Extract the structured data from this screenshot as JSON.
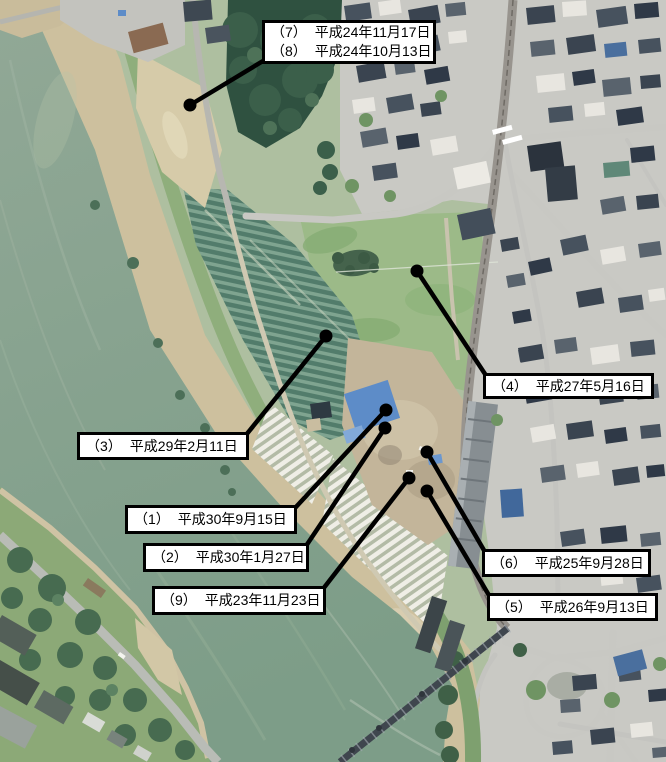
{
  "figure": {
    "type": "annotated-aerial-photo",
    "marker_shape": "filled-circle",
    "label_style": "white-box-black-border"
  },
  "annotations": [
    {
      "id": "site-7-8",
      "dot": {
        "x": 190,
        "y": 105
      },
      "anchor": {
        "x": 263,
        "y": 61
      },
      "box": {
        "x": 262,
        "y": 20,
        "w": 174,
        "h": 44
      },
      "entries": [
        {
          "no": "（7）",
          "date": "平成24年11月17日"
        },
        {
          "no": "（8）",
          "date": "平成24年10月13日"
        }
      ]
    },
    {
      "id": "site-4",
      "dot": {
        "x": 417,
        "y": 271
      },
      "anchor": {
        "x": 487,
        "y": 377
      },
      "box": {
        "x": 483,
        "y": 373,
        "w": 171,
        "h": 26
      },
      "entries": [
        {
          "no": "（4）",
          "date": "平成27年5月16日"
        }
      ]
    },
    {
      "id": "site-3",
      "dot": {
        "x": 326,
        "y": 336
      },
      "anchor": {
        "x": 246,
        "y": 435
      },
      "box": {
        "x": 77,
        "y": 432,
        "w": 172,
        "h": 28
      },
      "entries": [
        {
          "no": "（3）",
          "date": "平成29年2月11日"
        }
      ]
    },
    {
      "id": "site-1",
      "dot": {
        "x": 386,
        "y": 410
      },
      "anchor": {
        "x": 295,
        "y": 508
      },
      "box": {
        "x": 125,
        "y": 505,
        "w": 172,
        "h": 29
      },
      "entries": [
        {
          "no": "（1）",
          "date": "平成30年9月15日"
        }
      ]
    },
    {
      "id": "site-2",
      "dot": {
        "x": 385,
        "y": 428
      },
      "anchor": {
        "x": 306,
        "y": 546
      },
      "box": {
        "x": 143,
        "y": 543,
        "w": 166,
        "h": 29
      },
      "entries": [
        {
          "no": "（2）",
          "date": "平成30年1月27日"
        }
      ]
    },
    {
      "id": "site-9",
      "dot": {
        "x": 409,
        "y": 478
      },
      "anchor": {
        "x": 323,
        "y": 589
      },
      "box": {
        "x": 152,
        "y": 586,
        "w": 174,
        "h": 29
      },
      "entries": [
        {
          "no": "（9）",
          "date": "平成23年11月23日"
        }
      ]
    },
    {
      "id": "site-6",
      "dot": {
        "x": 427,
        "y": 452
      },
      "anchor": {
        "x": 485,
        "y": 552
      },
      "box": {
        "x": 482,
        "y": 549,
        "w": 169,
        "h": 28
      },
      "entries": [
        {
          "no": "（6）",
          "date": "平成25年9月28日"
        }
      ]
    },
    {
      "id": "site-5",
      "dot": {
        "x": 427,
        "y": 491
      },
      "anchor": {
        "x": 490,
        "y": 597
      },
      "box": {
        "x": 487,
        "y": 593,
        "w": 171,
        "h": 28
      },
      "entries": [
        {
          "no": "（5）",
          "date": "平成26年9月13日"
        }
      ]
    }
  ],
  "style": {
    "marker_color": "#000000",
    "leader_line_width": 4.5,
    "dot_radius": 6.5,
    "label_bg": "#ffffff",
    "label_border": "#000000"
  },
  "map_palette": {
    "water": "#8aa394",
    "water_deep": "#7f9e89",
    "sand": "#cdc09e",
    "grass": "#9cba88",
    "crop_field_dark": "#527c6b",
    "crop_field_light": "#7fa490",
    "forest": "#2f5140",
    "urban_ground": "#c9c9c4",
    "roof_dark": "#3a4450",
    "roof_light": "#e8e6e0",
    "road": "#c6c6c1",
    "railway": "#98948e",
    "bridge": "#3f464e",
    "tarp_blue": "#5d8cc8",
    "greenhouse_white": "#efeee6"
  }
}
